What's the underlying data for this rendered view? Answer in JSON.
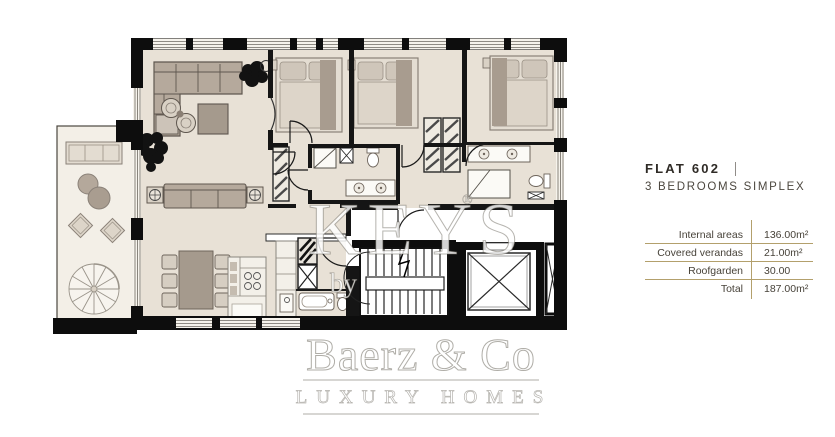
{
  "flat": {
    "name": "FLAT 602",
    "separator": "|",
    "subtitle": "3 BEDROOMS SIMPLEX"
  },
  "areas": {
    "rows": [
      {
        "label": "Internal areas",
        "value": "136.00m²"
      },
      {
        "label": "Covered verandas",
        "value": "21.00m²"
      },
      {
        "label": "Roofgarden",
        "value": "30.00"
      },
      {
        "label": "Total",
        "value": "187.00m²"
      }
    ]
  },
  "watermark": {
    "brand": "KEYS",
    "reg": "®",
    "by": "by",
    "company": "Baerz & Co",
    "tagline": "LUXURY HOMES"
  },
  "colors": {
    "accent_gold": "#b3a06c",
    "wall_black": "#0d0d0d",
    "floor_beige": "#e8e1d6",
    "terrace_beige": "#f3efe7",
    "furniture_taupe": "#b5a99c"
  }
}
